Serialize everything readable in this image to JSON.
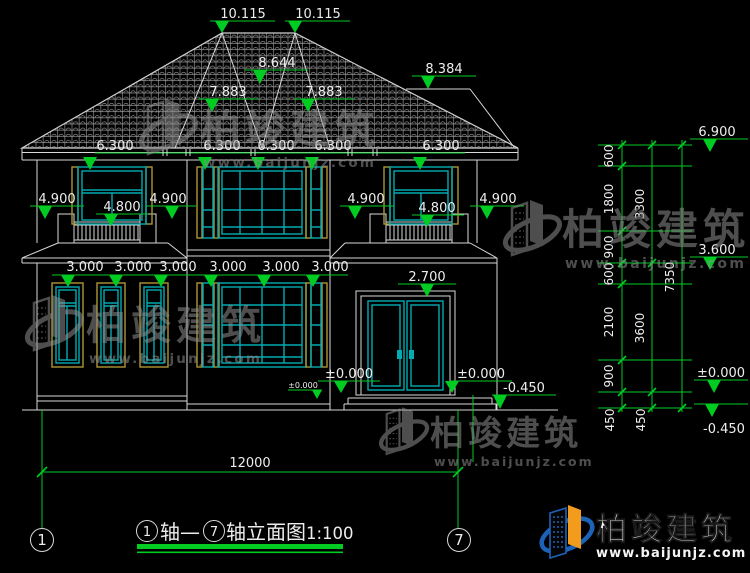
{
  "drawing": {
    "elevation_marks": {
      "ridge_left": "10.115",
      "ridge_right": "10.115",
      "upper_mid": "8.644",
      "upper_right": "8.384",
      "hip_left": "7.883",
      "hip_right": "7.883",
      "eave": [
        "6.300",
        "6.300",
        "6.300",
        "6.300",
        "6.300"
      ],
      "balcony_left": [
        "4.900",
        "4.800",
        "4.900"
      ],
      "balcony_right": [
        "4.900",
        "4.800",
        "4.900"
      ],
      "floor2": [
        "3.000",
        "3.000",
        "3.000",
        "3.000",
        "3.000",
        "3.000"
      ],
      "door_head": "2.700",
      "zero_left": "±0.000",
      "zero_right": "±0.000",
      "zero_small": "±0.000",
      "ground": "-0.450"
    },
    "right_dim_chain": {
      "inner": [
        "600",
        "1800",
        "900",
        "600",
        "2100",
        "900",
        "450"
      ],
      "middle": [
        "3300",
        "3600",
        "450"
      ],
      "overall": "7350",
      "elevations": [
        "6.900",
        "3.600",
        "±0.000",
        "-0.450"
      ]
    },
    "bottom_dim": {
      "overall_width": "12000"
    },
    "axis_bubbles": {
      "left": "1",
      "right": "7"
    }
  },
  "title_block": {
    "axis_left": "1",
    "connector": "轴—",
    "axis_right": "7",
    "suffix": "轴立面图",
    "scale": "1:100"
  },
  "branding": {
    "company": "柏竣建筑",
    "website": "www.baijunjz.com"
  },
  "colors": {
    "background": "#000000",
    "linework": "#d9d9d9",
    "dimension_green": "#00cc22",
    "window_teal": "#00abb2",
    "trim_khaki": "#ac9733",
    "logo_blue": "#1c63b8",
    "logo_orange": "#f29b1d",
    "watermark_gray": "#8f8f8f"
  }
}
